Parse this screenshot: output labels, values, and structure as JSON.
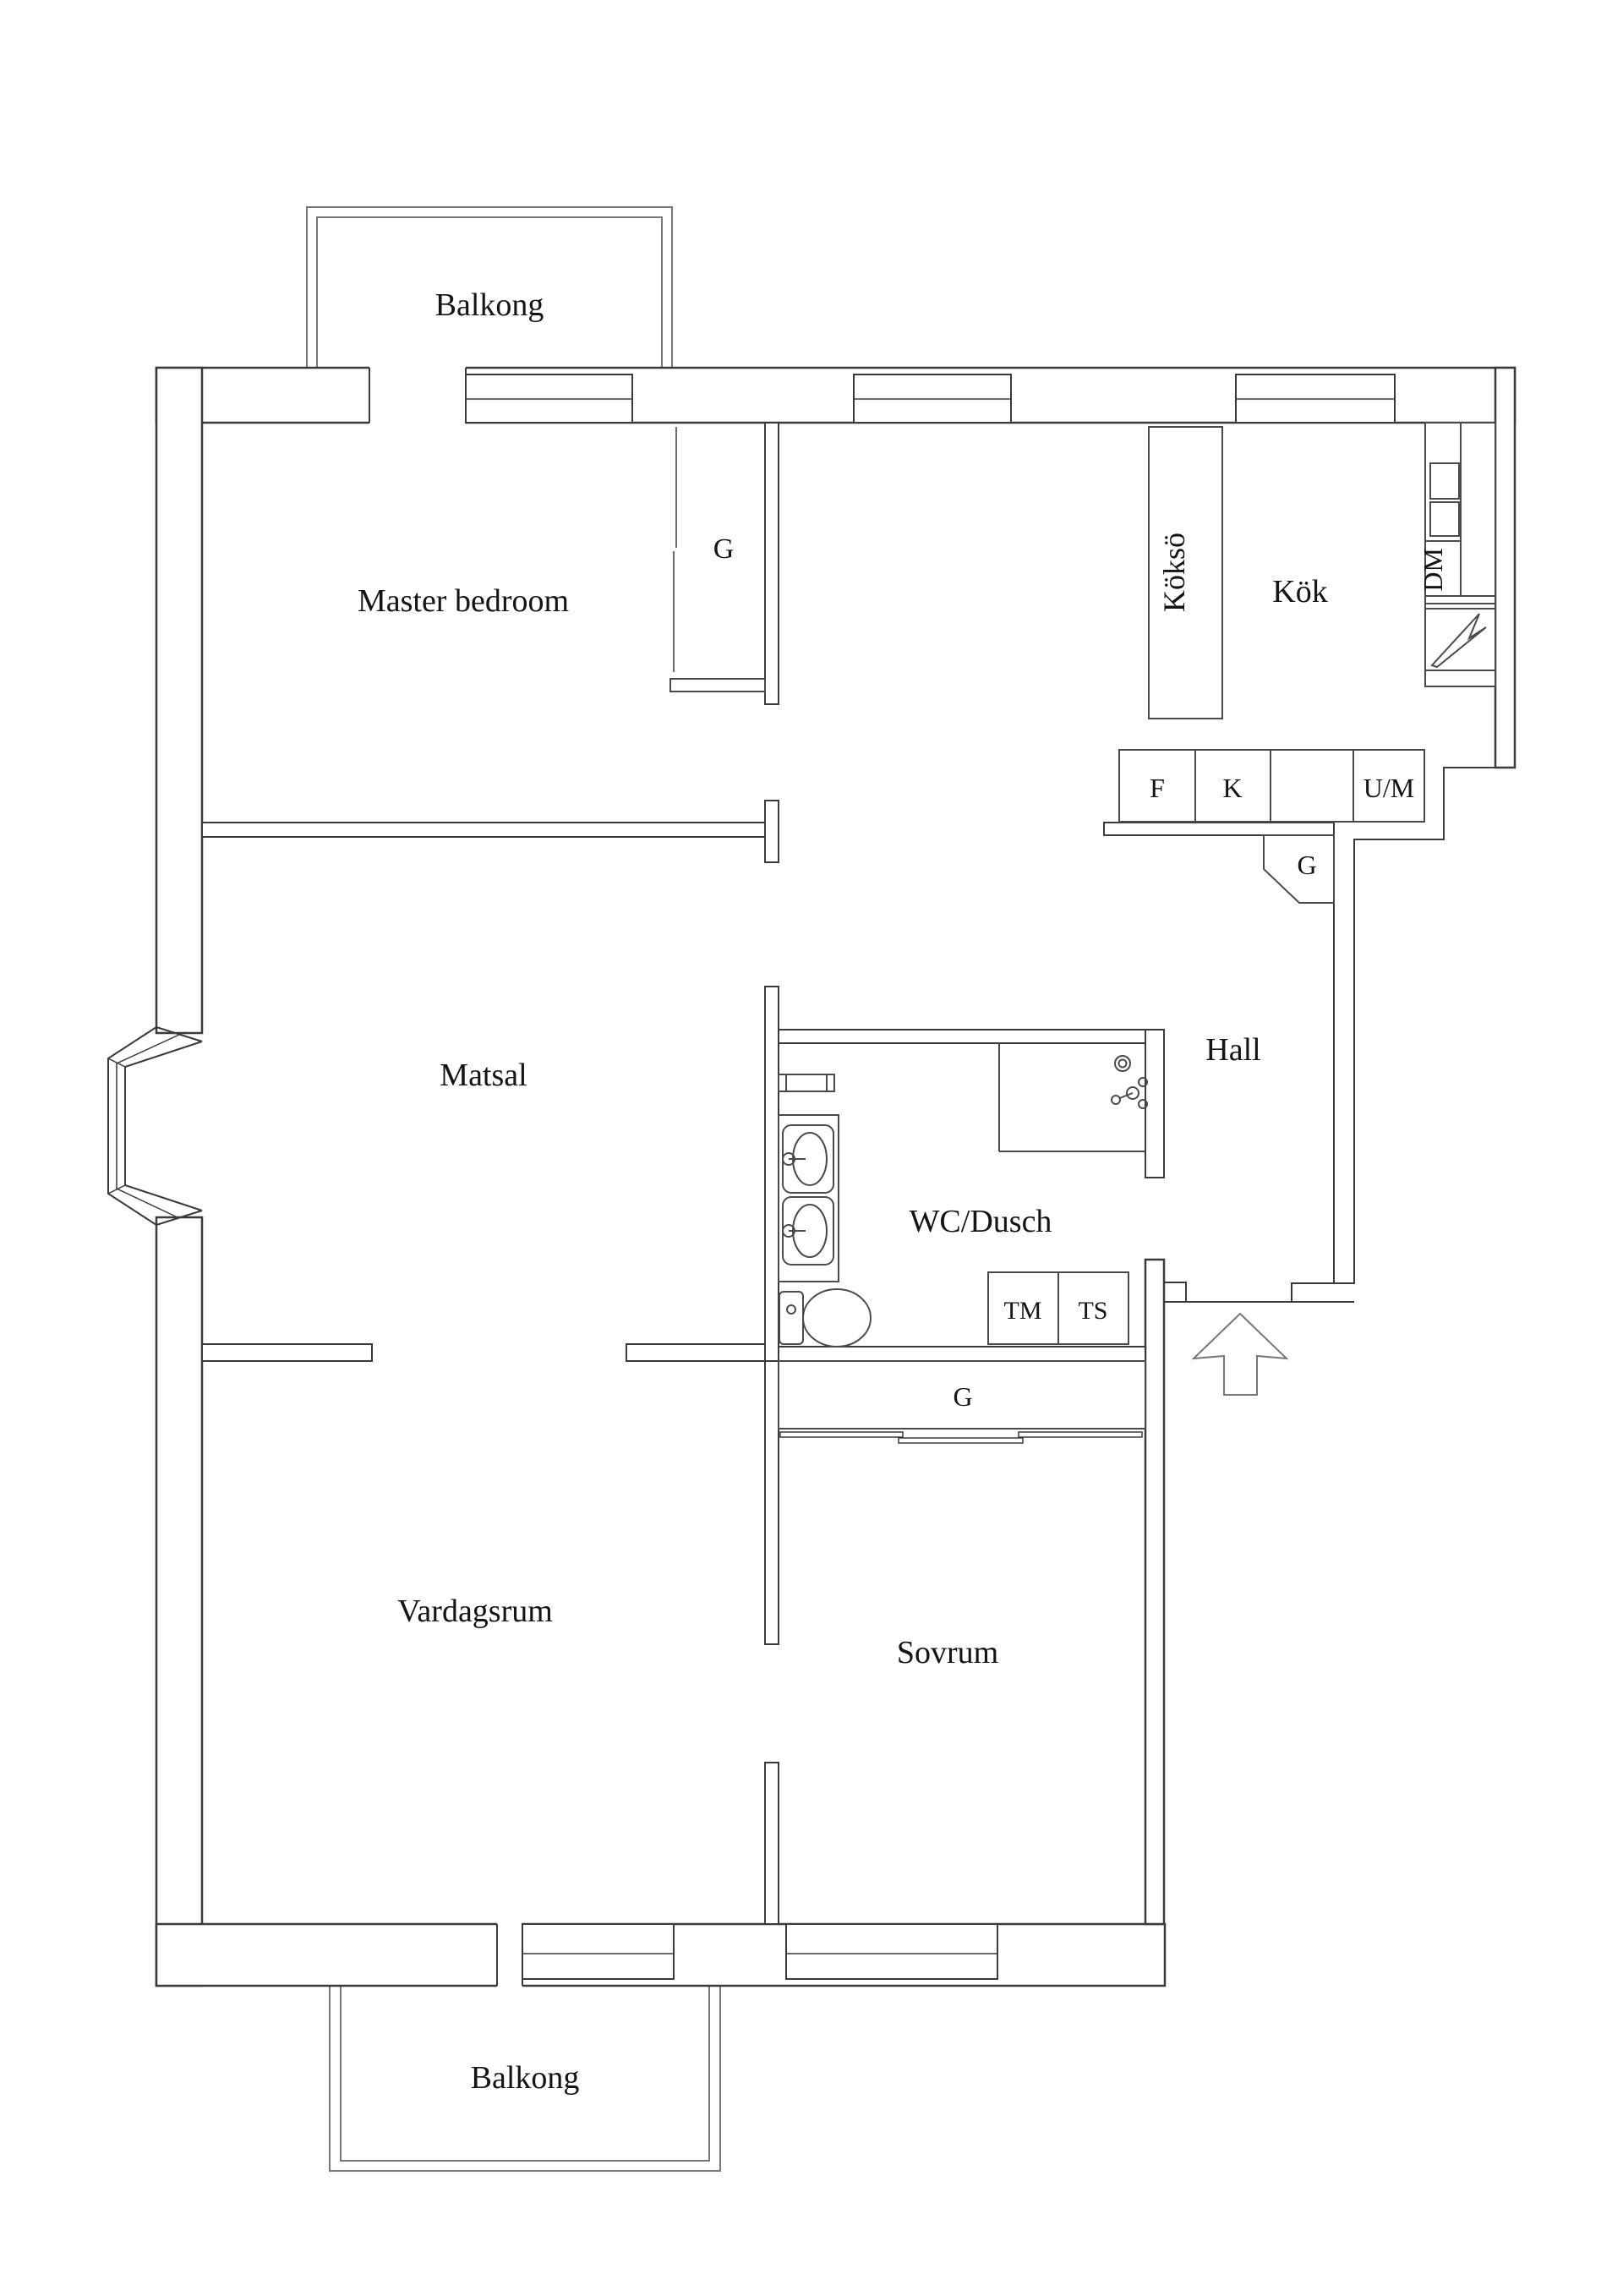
{
  "floor_plan": {
    "labels": {
      "balcony_top": "Balkong",
      "master_bedroom": "Master bedroom",
      "wardrobe_master": "G",
      "kitchen_island": "Köksö",
      "kitchen": "Kök",
      "dishwasher": "DM",
      "fridge": "F",
      "freezer": "K",
      "oven_microwave": "U/M",
      "closet_hall": "G",
      "hall": "Hall",
      "dining_room": "Matsal",
      "bathroom": "WC/Dusch",
      "washing_machine": "TM",
      "dryer": "TS",
      "closet_bedroom": "G",
      "living_room": "Vardagsrum",
      "bedroom": "Sovrum",
      "balcony_bottom": "Balkong"
    },
    "colors": {
      "wall": "#3a3a3a",
      "fixture": "#4a4a4a",
      "light_line": "#777777",
      "text": "#141414",
      "background": "#ffffff"
    }
  }
}
